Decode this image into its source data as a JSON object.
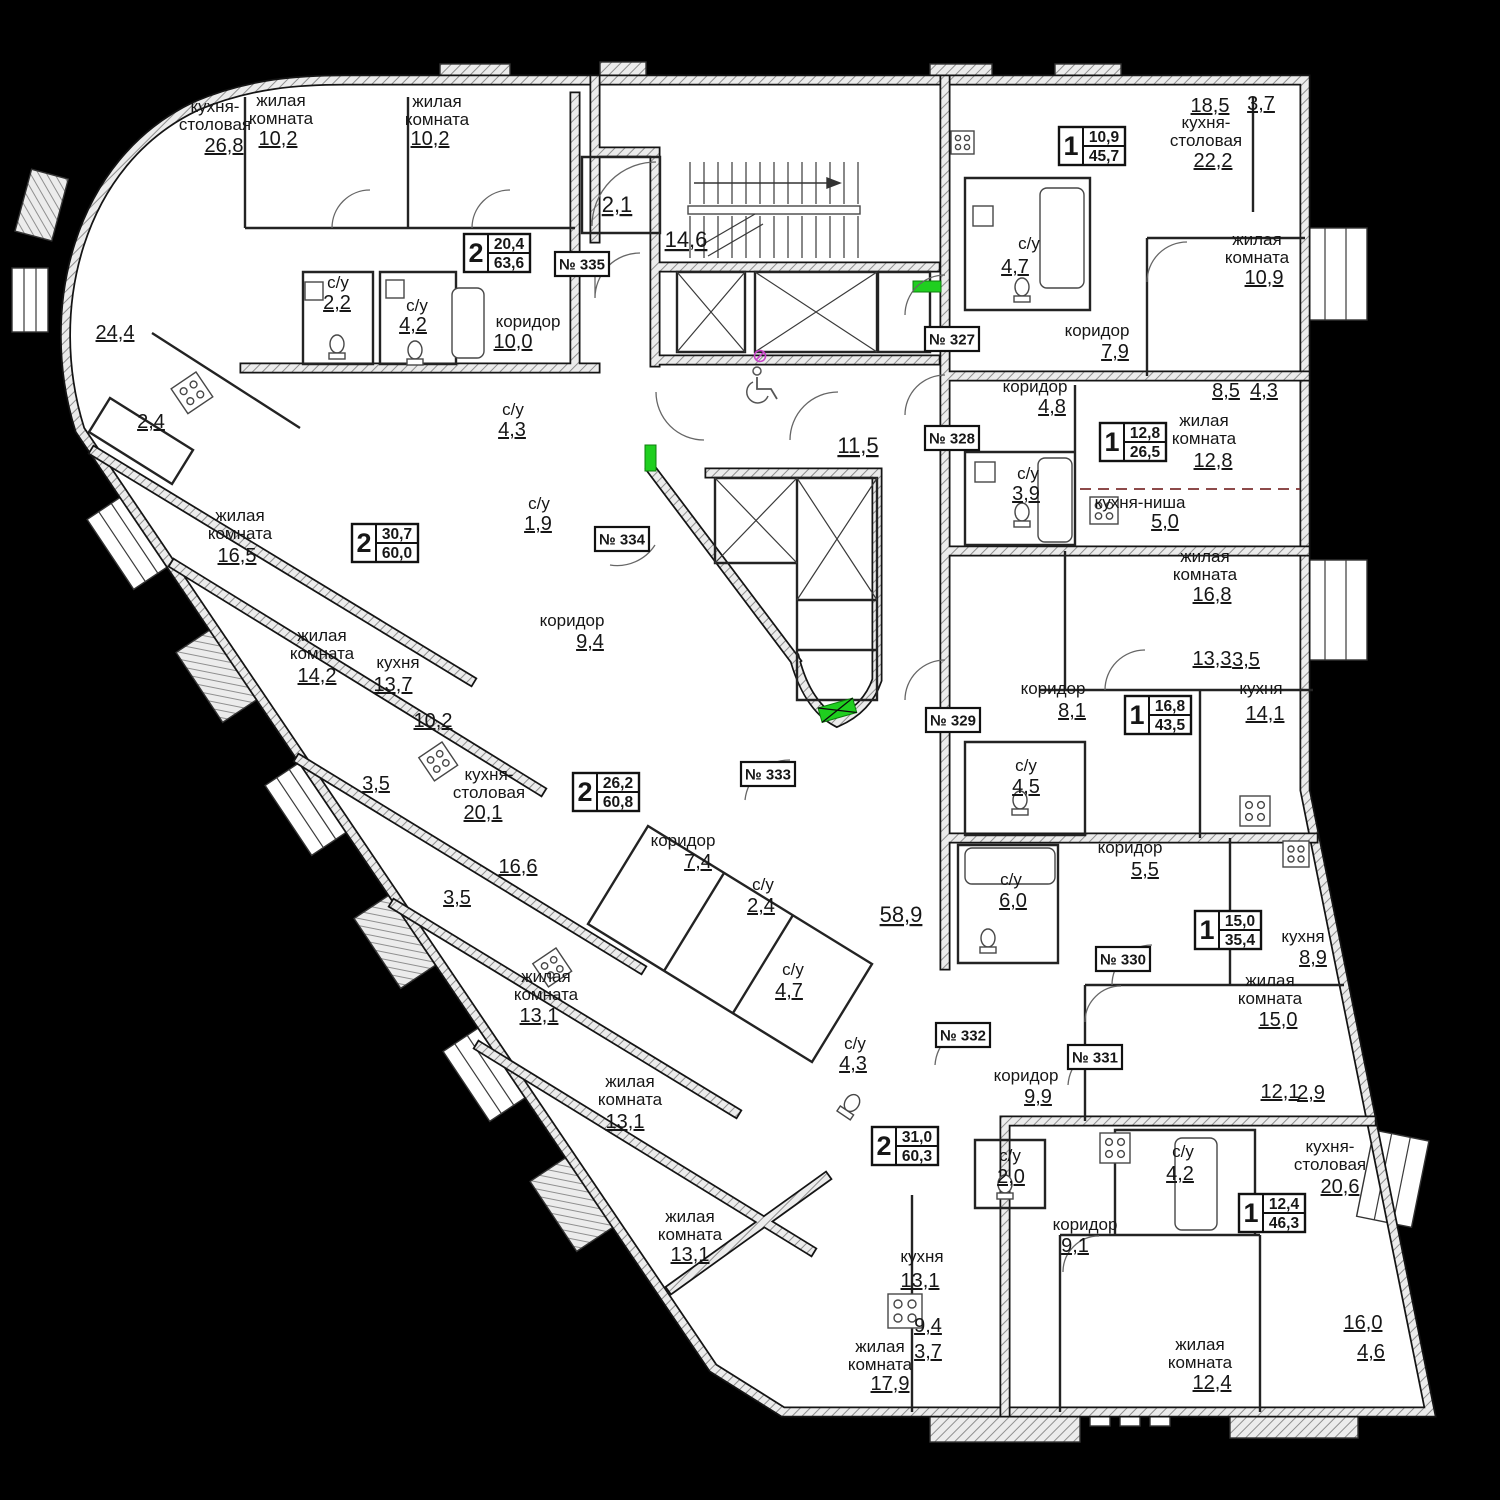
{
  "plan": {
    "language": "ru",
    "accent_green": "#1fcf1f",
    "wall_color": "#9a9a9a",
    "rooms": [
      {
        "lines": [
          "кухня-",
          "столовая"
        ],
        "area": "26,8",
        "x": 215,
        "y": 112,
        "ax": 224,
        "ay": 152
      },
      {
        "lines": [
          "жилая",
          "комната"
        ],
        "area": "10,2",
        "x": 281,
        "y": 106,
        "ax": 278,
        "ay": 145
      },
      {
        "lines": [
          "жилая",
          "комната"
        ],
        "area": "10,2",
        "x": 437,
        "y": 107,
        "ax": 430,
        "ay": 145
      },
      {
        "lines": [
          "с/у"
        ],
        "area": "2,2",
        "x": 338,
        "y": 288,
        "ax": 337,
        "ay": 309
      },
      {
        "lines": [
          "с/у"
        ],
        "area": "4,2",
        "x": 417,
        "y": 311,
        "ax": 413,
        "ay": 331
      },
      {
        "lines": [
          "коридор"
        ],
        "area": "10,0",
        "x": 528,
        "y": 327,
        "ax": 513,
        "ay": 348
      },
      {
        "lines": [
          "жилая",
          "комната"
        ],
        "area": "16,5",
        "x": 240,
        "y": 521,
        "ax": 237,
        "ay": 562
      },
      {
        "lines": [
          "жилая",
          "комната"
        ],
        "area": "14,2",
        "x": 322,
        "y": 641,
        "ax": 317,
        "ay": 682
      },
      {
        "lines": [
          "кухня"
        ],
        "area": "13,7",
        "x": 398,
        "y": 668,
        "ax": 393,
        "ay": 691
      },
      {
        "lines": [
          "с/у"
        ],
        "area": "4,3",
        "x": 513,
        "y": 415,
        "ax": 512,
        "ay": 436
      },
      {
        "lines": [
          "с/у"
        ],
        "area": "1,9",
        "x": 539,
        "y": 509,
        "ax": 538,
        "ay": 530
      },
      {
        "lines": [
          "коридор"
        ],
        "area": "9,4",
        "x": 572,
        "y": 626,
        "ax": 590,
        "ay": 648
      },
      {
        "lines": [
          "кухня-",
          "столовая"
        ],
        "area": "20,1",
        "x": 489,
        "y": 780,
        "ax": 483,
        "ay": 819
      },
      {
        "lines": [
          "жилая",
          "комната"
        ],
        "area": "13,1",
        "x": 546,
        "y": 982,
        "ax": 539,
        "ay": 1022
      },
      {
        "lines": [
          "жилая",
          "комната"
        ],
        "area": "13,1",
        "x": 630,
        "y": 1087,
        "ax": 625,
        "ay": 1128
      },
      {
        "lines": [
          "коридор"
        ],
        "area": "7,4",
        "x": 683,
        "y": 846,
        "ax": 698,
        "ay": 868
      },
      {
        "lines": [
          "с/у"
        ],
        "area": "2,4",
        "x": 763,
        "y": 890,
        "ax": 761,
        "ay": 912
      },
      {
        "lines": [
          "с/у"
        ],
        "area": "4,7",
        "x": 793,
        "y": 975,
        "ax": 789,
        "ay": 997
      },
      {
        "lines": [
          "с/у"
        ],
        "area": "4,3",
        "x": 855,
        "y": 1049,
        "ax": 853,
        "ay": 1070
      },
      {
        "lines": [
          "жилая",
          "комната"
        ],
        "area": "13,1",
        "x": 690,
        "y": 1222,
        "ax": 690,
        "ay": 1261
      },
      {
        "lines": [
          "жилая",
          "комната"
        ],
        "area": "17,9",
        "x": 880,
        "y": 1352,
        "ax": 890,
        "ay": 1390
      },
      {
        "lines": [
          "кухня"
        ],
        "area": "13,1",
        "x": 922,
        "y": 1262,
        "ax": 920,
        "ay": 1287
      },
      {
        "lines": [
          "с/у"
        ],
        "area": "2,0",
        "x": 1010,
        "y": 1161,
        "ax": 1011,
        "ay": 1183
      },
      {
        "lines": [
          "коридор"
        ],
        "area": "9,9",
        "x": 1026,
        "y": 1081,
        "ax": 1038,
        "ay": 1103
      },
      {
        "lines": [
          "коридор"
        ],
        "area": "9,1",
        "x": 1085,
        "y": 1230,
        "ax": 1075,
        "ay": 1252
      },
      {
        "lines": [
          "с/у"
        ],
        "area": "4,2",
        "x": 1183,
        "y": 1157,
        "ax": 1180,
        "ay": 1180
      },
      {
        "lines": [
          "кухня-",
          "столовая"
        ],
        "area": "20,6",
        "x": 1330,
        "y": 1152,
        "ax": 1340,
        "ay": 1193
      },
      {
        "lines": [
          "жилая",
          "комната"
        ],
        "area": "12,4",
        "x": 1200,
        "y": 1350,
        "ax": 1212,
        "ay": 1389
      },
      {
        "lines": [
          "коридор"
        ],
        "area": "5,5",
        "x": 1130,
        "y": 853,
        "ax": 1145,
        "ay": 876
      },
      {
        "lines": [
          "с/у"
        ],
        "area": "6,0",
        "x": 1011,
        "y": 885,
        "ax": 1013,
        "ay": 907
      },
      {
        "lines": [
          "с/у"
        ],
        "area": "4,5",
        "x": 1026,
        "y": 771,
        "ax": 1026,
        "ay": 793
      },
      {
        "lines": [
          "кухня"
        ],
        "area": "8,9",
        "x": 1303,
        "y": 942,
        "ax": 1313,
        "ay": 964
      },
      {
        "lines": [
          "жилая",
          "комната"
        ],
        "area": "15,0",
        "x": 1270,
        "y": 986,
        "ax": 1278,
        "ay": 1026
      },
      {
        "lines": [
          "коридор"
        ],
        "area": "8,1",
        "x": 1053,
        "y": 694,
        "ax": 1072,
        "ay": 717
      },
      {
        "lines": [
          "жилая",
          "комната"
        ],
        "area": "16,8",
        "x": 1205,
        "y": 562,
        "ax": 1212,
        "ay": 601
      },
      {
        "lines": [
          "кухня"
        ],
        "area": "14,1",
        "x": 1261,
        "y": 694,
        "ax": 1265,
        "ay": 720
      },
      {
        "lines": [
          "коридор"
        ],
        "area": "4,8",
        "x": 1035,
        "y": 392,
        "ax": 1052,
        "ay": 413
      },
      {
        "lines": [
          "с/у"
        ],
        "area": "3,9",
        "x": 1028,
        "y": 479,
        "ax": 1026,
        "ay": 500
      },
      {
        "lines": [
          "кухня-ниша"
        ],
        "area": "5,0",
        "x": 1140,
        "y": 508,
        "ax": 1165,
        "ay": 528
      },
      {
        "lines": [
          "жилая",
          "комната"
        ],
        "area": "12,8",
        "x": 1204,
        "y": 426,
        "ax": 1213,
        "ay": 467
      },
      {
        "lines": [
          "кухня-",
          "столовая"
        ],
        "area": "22,2",
        "x": 1206,
        "y": 128,
        "ax": 1213,
        "ay": 167
      },
      {
        "lines": [
          "жилая",
          "комната"
        ],
        "area": "10,9",
        "x": 1257,
        "y": 245,
        "ax": 1264,
        "ay": 284
      },
      {
        "lines": [
          "с/у"
        ],
        "area": "4,7",
        "x": 1029,
        "y": 249,
        "ax": 1015,
        "ay": 273
      },
      {
        "lines": [
          "коридор"
        ],
        "area": "7,9",
        "x": 1097,
        "y": 336,
        "ax": 1115,
        "ay": 358
      }
    ],
    "dims": [
      {
        "v": "18,5",
        "x": 1210,
        "y": 112
      },
      {
        "v": "3,7",
        "x": 1261,
        "y": 110
      },
      {
        "v": "8,5",
        "x": 1226,
        "y": 397
      },
      {
        "v": "4,3",
        "x": 1264,
        "y": 397
      },
      {
        "v": "13,3",
        "x": 1212,
        "y": 665
      },
      {
        "v": "3,5",
        "x": 1246,
        "y": 666
      },
      {
        "v": "12,1",
        "x": 1280,
        "y": 1098
      },
      {
        "v": "2,9",
        "x": 1311,
        "y": 1099
      },
      {
        "v": "16,0",
        "x": 1363,
        "y": 1329
      },
      {
        "v": "4,6",
        "x": 1371,
        "y": 1358
      },
      {
        "v": "24,4",
        "x": 115,
        "y": 339
      },
      {
        "v": "2,4",
        "x": 151,
        "y": 428
      },
      {
        "v": "10,2",
        "x": 433,
        "y": 727
      },
      {
        "v": "3,5",
        "x": 376,
        "y": 790
      },
      {
        "v": "16,6",
        "x": 518,
        "y": 873
      },
      {
        "v": "3,5",
        "x": 457,
        "y": 904
      },
      {
        "v": "9,4",
        "x": 928,
        "y": 1332
      },
      {
        "v": "3,7",
        "x": 928,
        "y": 1358
      },
      {
        "v": "2,1",
        "x": 617,
        "y": 212,
        "big": true
      },
      {
        "v": "14,6",
        "x": 686,
        "y": 247,
        "big": true
      },
      {
        "v": "11,5",
        "x": 858,
        "y": 453,
        "big": true
      },
      {
        "v": "58,9",
        "x": 901,
        "y": 922,
        "big": true
      }
    ],
    "apartments": [
      {
        "num": "№ 327",
        "rooms": "1",
        "a1": "10,9",
        "a2": "45,7",
        "bx": 1092,
        "by": 146,
        "nx": 952,
        "ny": 339
      },
      {
        "num": "№ 328",
        "rooms": "1",
        "a1": "12,8",
        "a2": "26,5",
        "bx": 1133,
        "by": 442,
        "nx": 952,
        "ny": 438
      },
      {
        "num": "№ 329",
        "rooms": "1",
        "a1": "16,8",
        "a2": "43,5",
        "bx": 1158,
        "by": 715,
        "nx": 953,
        "ny": 720
      },
      {
        "num": "№ 330",
        "rooms": "1",
        "a1": "15,0",
        "a2": "35,4",
        "bx": 1228,
        "by": 930,
        "nx": 1123,
        "ny": 959
      },
      {
        "num": "№ 331",
        "rooms": "1",
        "a1": "12,4",
        "a2": "46,3",
        "bx": 1272,
        "by": 1213,
        "nx": 1095,
        "ny": 1057
      },
      {
        "num": "№ 332",
        "rooms": "2",
        "a1": "31,0",
        "a2": "60,3",
        "bx": 905,
        "by": 1146,
        "nx": 963,
        "ny": 1035
      },
      {
        "num": "№ 333",
        "rooms": "2",
        "a1": "26,2",
        "a2": "60,8",
        "bx": 606,
        "by": 792,
        "nx": 768,
        "ny": 774
      },
      {
        "num": "№ 334",
        "rooms": "2",
        "a1": "30,7",
        "a2": "60,0",
        "bx": 385,
        "by": 543,
        "nx": 622,
        "ny": 539
      },
      {
        "num": "№ 335",
        "rooms": "2",
        "a1": "20,4",
        "a2": "63,6",
        "bx": 497,
        "by": 253,
        "nx": 582,
        "ny": 264
      }
    ]
  }
}
